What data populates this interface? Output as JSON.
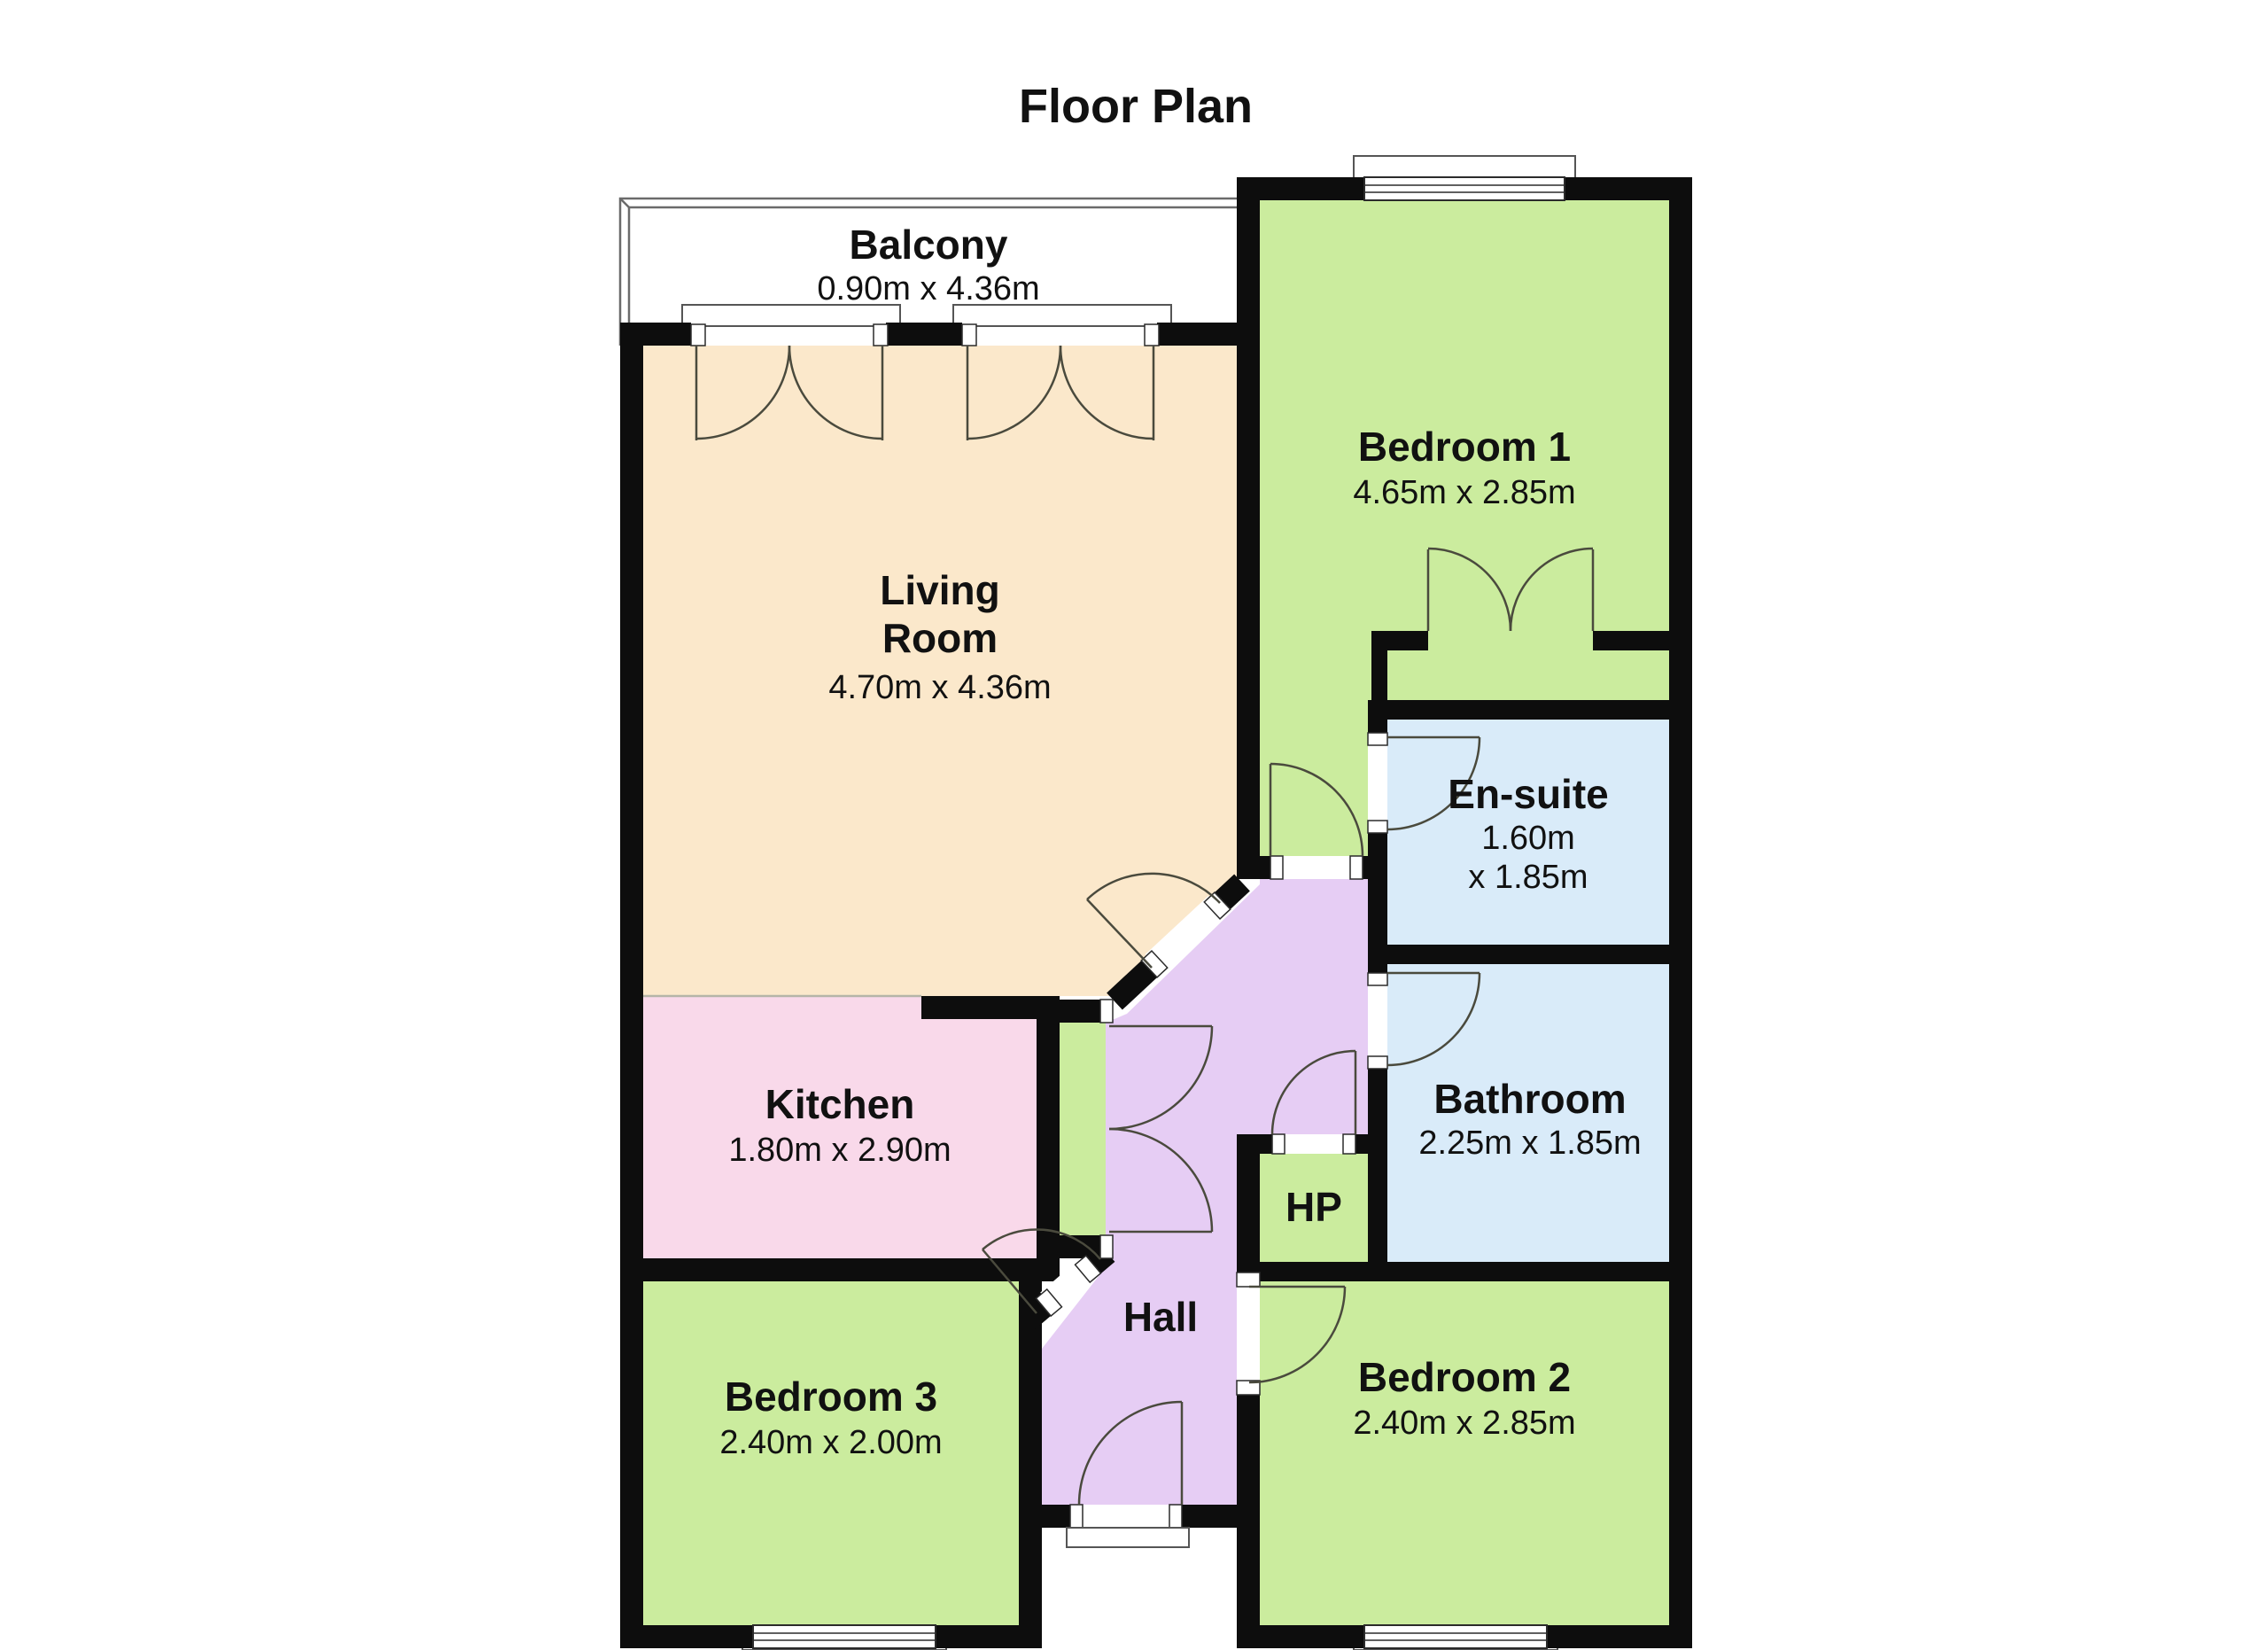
{
  "title": "Floor Plan",
  "colors": {
    "wall": "#0d0d0d",
    "bedroom_green": "#cbec9e",
    "living_peach": "#fbe8cb",
    "kitchen_pink": "#f9d9ea",
    "bath_blue": "#d9ebf9",
    "hall_purple": "#e6cdf4",
    "balcony_white": "#ffffff"
  },
  "rooms": {
    "balcony": {
      "name": "Balcony",
      "dims": "0.90m x 4.36m"
    },
    "living": {
      "name_line1": "Living",
      "name_line2": "Room",
      "dims": "4.70m x 4.36m"
    },
    "bedroom1": {
      "name": "Bedroom 1",
      "dims": "4.65m x 2.85m"
    },
    "ensuite": {
      "name": "En-suite",
      "dims_line1": "1.60m",
      "dims_line2": "x 1.85m"
    },
    "kitchen": {
      "name": "Kitchen",
      "dims": "1.80m x 2.90m"
    },
    "bathroom": {
      "name": "Bathroom",
      "dims": "2.25m x 1.85m"
    },
    "hp": {
      "name": "HP"
    },
    "hall": {
      "name": "Hall"
    },
    "bedroom3": {
      "name": "Bedroom 3",
      "dims": "2.40m x 2.00m"
    },
    "bedroom2": {
      "name": "Bedroom 2",
      "dims": "2.40m x 2.85m"
    }
  }
}
